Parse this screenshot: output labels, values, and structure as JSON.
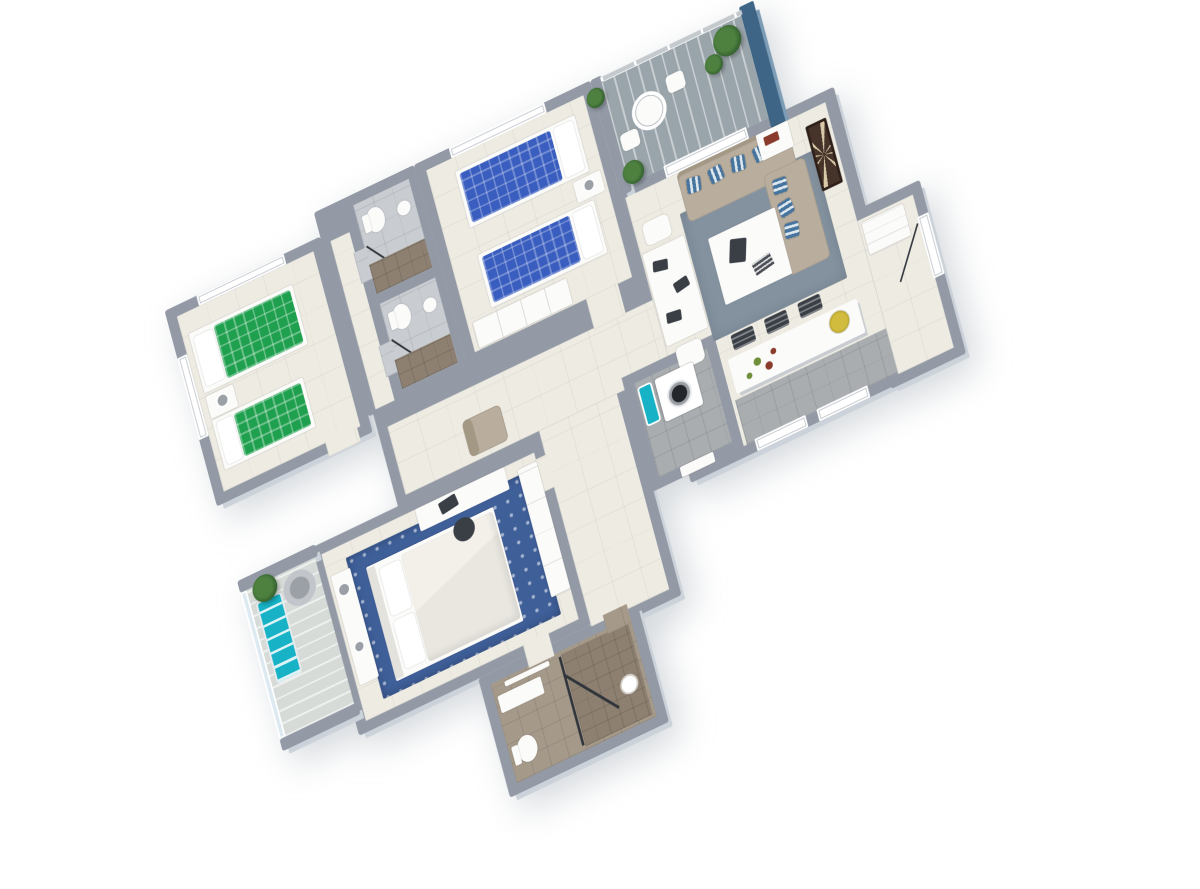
{
  "scene": {
    "type": "isometric-3d-floorplan-render",
    "background": "#ffffff",
    "view": "top-down oblique, plan rotated ~26 degrees counter-clockwise",
    "apartment": "2-3 bedroom apartment with two balconies"
  },
  "palette": {
    "wall": "#939aa6",
    "wall-side": "#ccd2d9",
    "floor-cream": "#edebe2",
    "tile-lt": "#c9cdd2",
    "tile-md": "#a9adb0",
    "tile-tan": "#a5998a",
    "tile-tan-dk": "#8d8071",
    "deck": "#9aa5ab",
    "deck-lt": "#d6dbd8",
    "glass": "#dce9f0",
    "accent-blue-wall": "#3e6486",
    "bed-green": "#1fa04e",
    "bed-blue": "#3a5ec0",
    "pillow": "#ffffff",
    "sofa": "#b9ae9e",
    "sofa-dk": "#a39884",
    "pillow-stripe-a": "#46749e",
    "pillow-stripe-b": "#dde7ee",
    "rug-living": "#8492a0",
    "rug-master": "#3f5f99",
    "duvet": "#e9e7e0",
    "white-furn": "#fbfbfa",
    "dark-item": "#3a3f46",
    "art-brown": "#46332a",
    "art-cream": "#d8c9a8",
    "teal": "#17b2c6",
    "plant": "#4e8040",
    "plant-dk": "#2f5c2b",
    "fruit-yellow": "#d2bc3e",
    "fruit-red": "#8a3b2c",
    "fruit-green": "#6f8f3a",
    "washer-door": "#23272c",
    "shadowline": "#c3c9cd"
  },
  "rooms": [
    {
      "name": "bedroom-green",
      "position": "top-left",
      "items": [
        "twin bed green plaid",
        "single bed green plaid",
        "nightstand with lamp",
        "north window",
        "west window"
      ]
    },
    {
      "name": "bathroom-1",
      "position": "top-middle",
      "items": [
        "toilet",
        "round basin",
        "dark shower tile",
        "sliding door"
      ]
    },
    {
      "name": "bathroom-2",
      "position": "middle",
      "items": [
        "toilet",
        "round basin",
        "dark shower tile",
        "sliding door"
      ]
    },
    {
      "name": "bedroom-blue",
      "position": "top-center",
      "items": [
        "twin bed blue plaid",
        "single bed blue plaid",
        "nightstand",
        "white wardrobe",
        "north window"
      ]
    },
    {
      "name": "balcony-main",
      "position": "top-right",
      "items": [
        "glass railing",
        "slatted deck",
        "round white table",
        "two white chairs",
        "palm plants",
        "navy accent wall"
      ]
    },
    {
      "name": "living-room",
      "position": "right",
      "items": [
        "beige 3-seat sofa",
        "beige 2-seat sofa",
        "7 blue striped pillows",
        "gray rug",
        "white coffee table with tablet and books",
        "side table with red books",
        "dark geometric wall art"
      ]
    },
    {
      "name": "dining-area",
      "position": "center-right",
      "items": [
        "white dining table",
        "white chairs",
        "dark placemats"
      ]
    },
    {
      "name": "kitchen",
      "position": "center-right-lower",
      "items": [
        "white bar counter",
        "three dark stools",
        "yellow fruit bowl",
        "loose fruits",
        "gray tile floor"
      ]
    },
    {
      "name": "utility-room",
      "position": "center-lower",
      "items": [
        "washing machine",
        "teal basin",
        "gray tile floor"
      ]
    },
    {
      "name": "entrance-hall",
      "position": "far-right-lower",
      "items": [
        "white entry door",
        "white cabinet"
      ]
    },
    {
      "name": "hallway",
      "position": "center",
      "items": [
        "beige armchair",
        "south windows"
      ]
    },
    {
      "name": "bedroom-master",
      "position": "bottom-left",
      "items": [
        "double bed white duvet",
        "blue ornate rug",
        "white dresser",
        "desk with chair and laptop",
        "white wardrobe"
      ]
    },
    {
      "name": "balcony-master",
      "position": "far-bottom-left",
      "items": [
        "teal lounger",
        "round wicker chair",
        "palm plant",
        "glass wall"
      ]
    },
    {
      "name": "bathroom-ensuite",
      "position": "bottom",
      "items": [
        "brown tile shower with glass door",
        "shower head",
        "toilet",
        "white vanity",
        "towel bar"
      ]
    }
  ]
}
